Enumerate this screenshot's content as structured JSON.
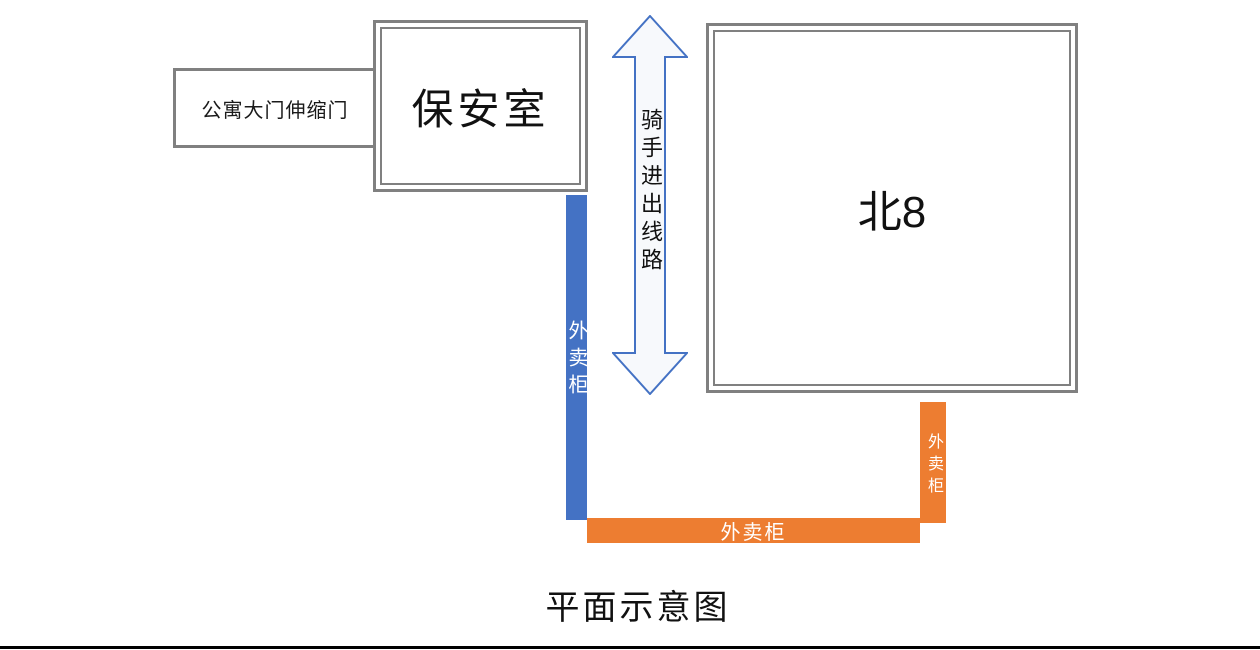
{
  "title": "平面示意图",
  "boxes": {
    "gate": {
      "label": "公寓大门伸缩门"
    },
    "security": {
      "label": "保安室"
    },
    "north8": {
      "label": "北8"
    }
  },
  "arrow": {
    "label": "骑手进出线路"
  },
  "lockers": {
    "left": {
      "label": "外卖柜",
      "color": "#4472C4"
    },
    "bottom": {
      "label": "外卖柜",
      "color": "#ED7D31"
    },
    "right": {
      "label": "外卖柜",
      "color": "#ED7D31"
    }
  },
  "colors": {
    "blue": "#4472C4",
    "orange": "#ED7D31",
    "border_gray": "#808080",
    "arrow_stroke": "#4472C4",
    "arrow_fill": "#F7F9FC",
    "rule_black": "#000000"
  }
}
